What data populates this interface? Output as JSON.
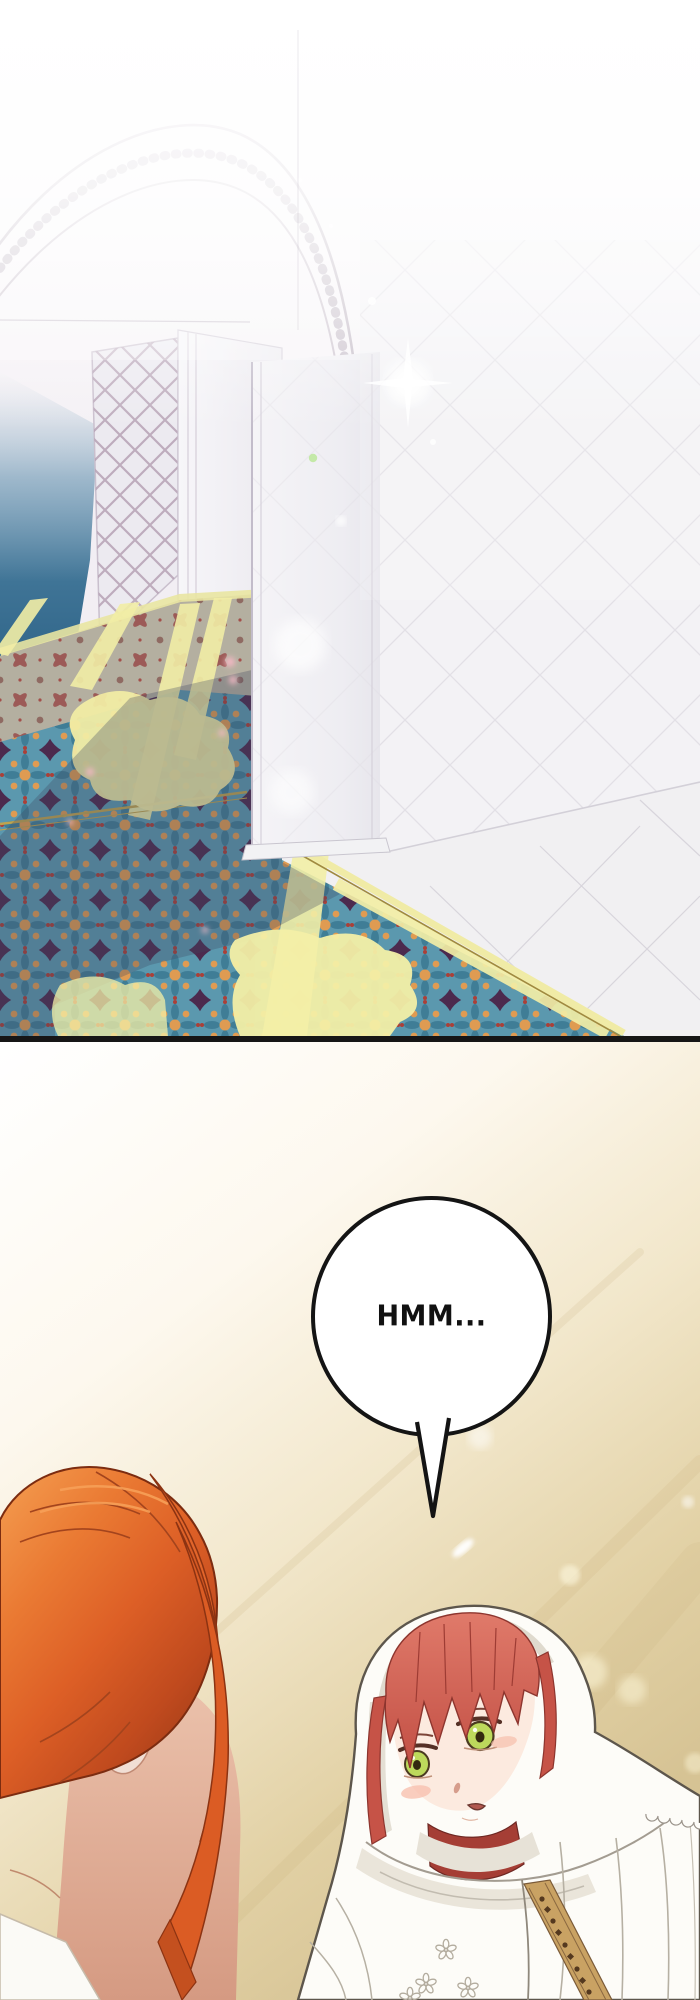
{
  "speech_bubble": {
    "text": "HMM..."
  },
  "palette": {
    "panel_border": "#161616",
    "bubble_border": "#141414",
    "carpet_teal": "#5b98ae",
    "carpet_orange": "#df9b52",
    "carpet_purple": "#4c2a4e",
    "carpet_red": "#aa4038",
    "sunlight_yellow": "#f2eda4",
    "wall_blue": "#2f6488",
    "marble_white": "#f1f0f2",
    "hair_orange": "#e06528",
    "hair_red": "#d0685c",
    "eye_green": "#bdd95c",
    "hood_white": "#fdfcf8",
    "skin_tone": "#fbeae0",
    "background_tan": "#d6c394"
  }
}
